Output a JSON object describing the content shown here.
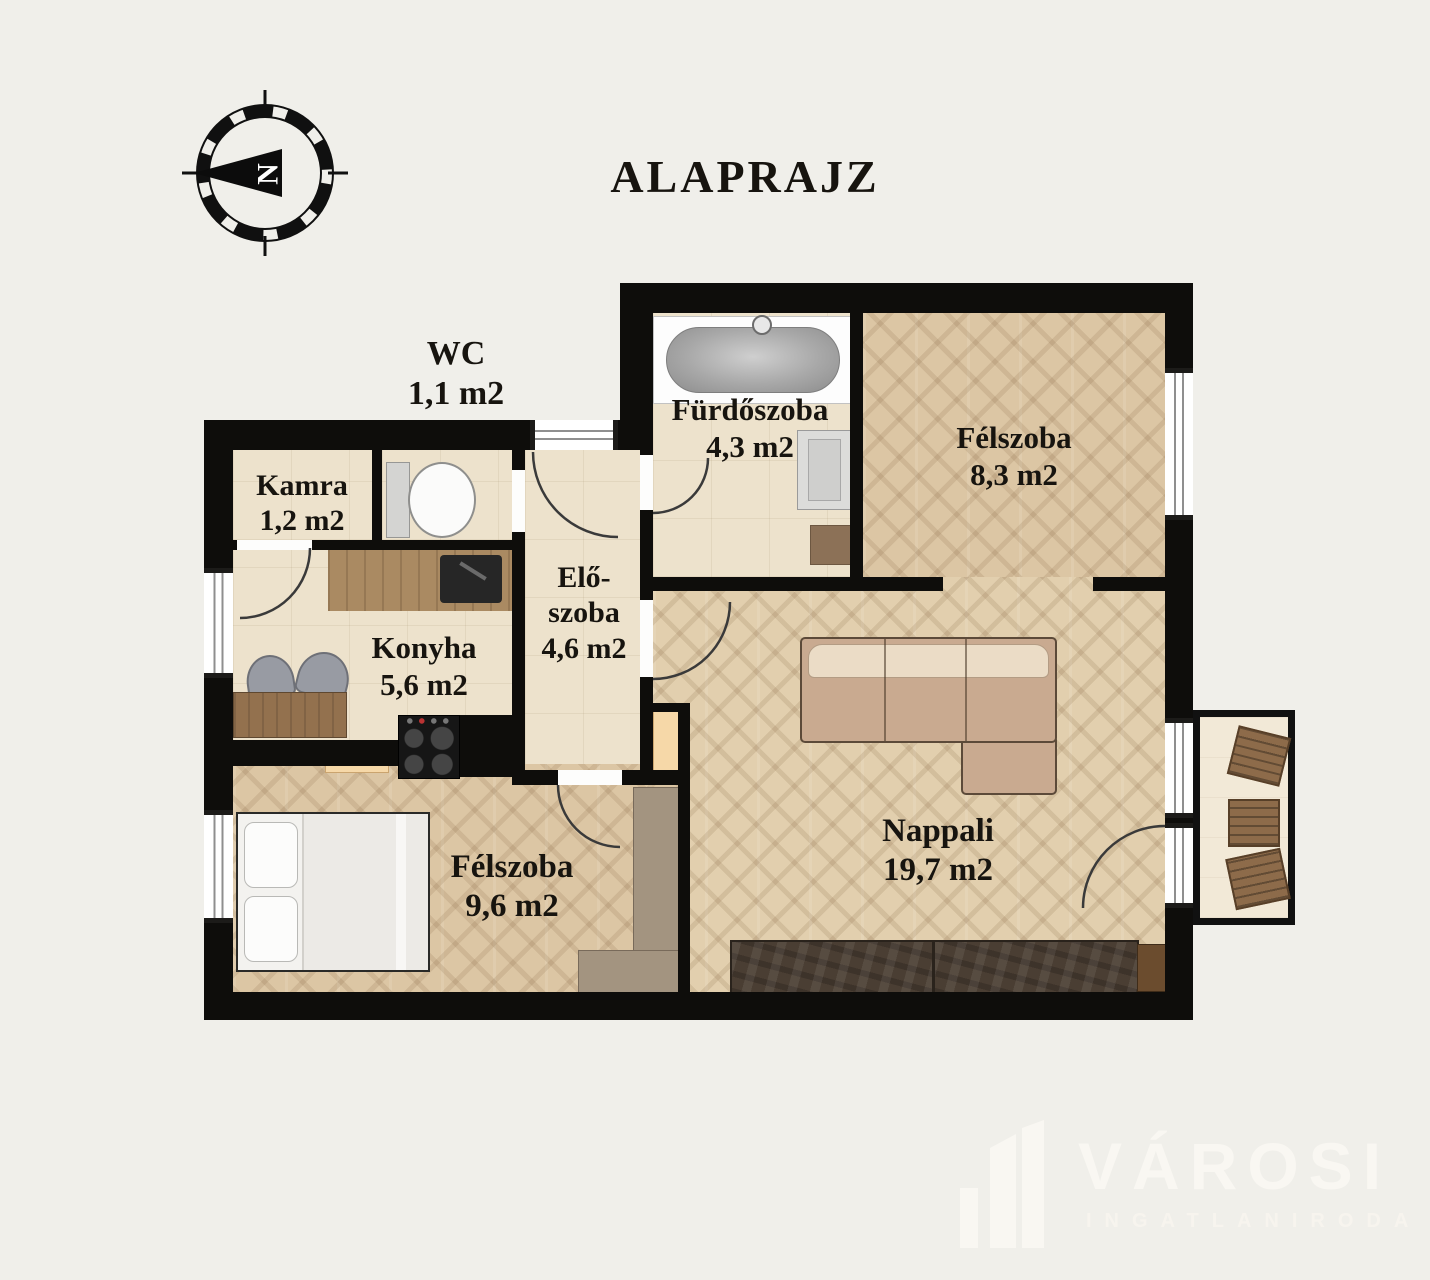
{
  "title": "ALAPRAJZ",
  "compass": {
    "letter": "N"
  },
  "rooms": {
    "wc": {
      "name": "WC",
      "area": "1,1 m2"
    },
    "kamra": {
      "name": "Kamra",
      "area": "1,2 m2"
    },
    "furdoszoba": {
      "name": "Fürdőszoba",
      "area": "4,3 m2"
    },
    "felszoba_felso": {
      "name": "Félszoba",
      "area": "8,3 m2"
    },
    "eloszoba": {
      "name_line1": "Elő-",
      "name_line2": "szoba",
      "area": "4,6 m2"
    },
    "konyha": {
      "name": "Konyha",
      "area": "5,6 m2"
    },
    "felszoba_also": {
      "name": "Félszoba",
      "area": "9,6 m2"
    },
    "nappali": {
      "name": "Nappali",
      "area": "19,7 m2"
    }
  },
  "watermark": {
    "brand": "VÁROSI",
    "subtitle": "INGATLANIRODA"
  },
  "colors": {
    "background": "#f0efea",
    "wall": "#0e0d0b",
    "floor_tile": "#ede2cc",
    "floor_wood": "#dcc6a4",
    "watermark": "#f9f7f2",
    "cabinet_accent": "#f6d8a8"
  },
  "icons": {
    "compass-icon": "svg-compass-rose-with-north-arrow",
    "bathtub-icon": "css-pill-in-white-surround",
    "washing-machine-icon": "css-square-with-door",
    "toilet-icon": "css-tank-plus-ellipse-bowl",
    "kitchen-sink-icon": "css-dark-rect-with-faucet",
    "stove-icon": "css-black-rect-4-burners",
    "dining-table-icon": "css-wood-rect",
    "chair-icon": "css-rounded-grey-rect",
    "bed-icon": "css-white-rect-with-pillows",
    "wardrobe-icon": "css-tan-rect",
    "sofa-icon": "css-l-shaped-beige-rect",
    "tv-cabinet-icon": "css-dark-textured-rect",
    "balcony-table-icon": "css-slatted-wood-square",
    "balcony-chair-icon": "css-slatted-wood-square-rotated"
  }
}
